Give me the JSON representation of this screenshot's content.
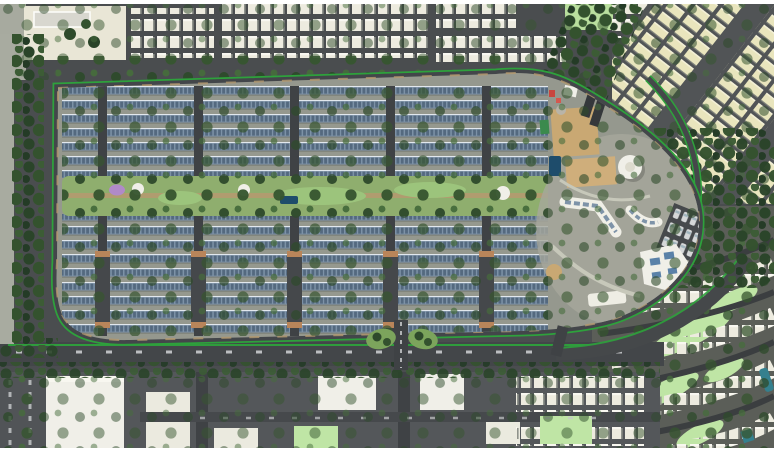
{
  "page": {
    "title": "Aerial master-plan rendering of a solar-roof residential community",
    "view": "top-down 3D site plan"
  },
  "palette": {
    "frame": "#ffffff",
    "asphalt": "#4a4d4f",
    "asphalt_dark": "#3f4245",
    "asphalt_light": "#54575a",
    "ground_dev": "#95988e",
    "ground_light": "#a7aa9f",
    "perimeter_green": "#2ea13c",
    "roof_blue": "#7d92a7",
    "solar_panel": "#54697f",
    "house_white": "#edebdf",
    "house_cream": "#e9e5bd",
    "tree_dark": "#2a4429",
    "tree_mid": "#34522e",
    "lawn_bright": "#b9df9e",
    "lawn_mint": "#bfe5a5",
    "park_green": "#8fae6e",
    "sand": "#c9a873",
    "pool": "#1e4c6b",
    "water_teal": "#35808e",
    "splash_purple": "#b08ac8",
    "building_white": "#f0efe8",
    "building_cream": "#e9e6d6",
    "path_tan": "#b49a6f",
    "playground_red": "#c9463f"
  },
  "scene": {
    "development": {
      "label": "gated residential community with rows of blue solar-panel rooftops"
    },
    "central_park": {
      "label": "central linear park with pool, splash pad and shade domes"
    },
    "amenity": {
      "label": "clubhouse and amenity zone with sand courts, dome pavilion, pool and parking"
    },
    "top_neighborhood": {
      "label": "existing neighborhood of white-roof houses north of site"
    },
    "right_neighborhood": {
      "label": "diagonal streets of cream-roof houses east of site"
    },
    "southeast_neighborhood": {
      "label": "curving streets of white houses with lawns, southeast"
    },
    "commercial": {
      "label": "commercial big-box buildings and parking south of arterial road"
    },
    "arterial": {
      "label": "tree-lined arterial road along south boundary"
    },
    "forest": {
      "label": "dense tree buffer"
    },
    "entrance": {
      "label": "main landscaped entrance"
    }
  }
}
